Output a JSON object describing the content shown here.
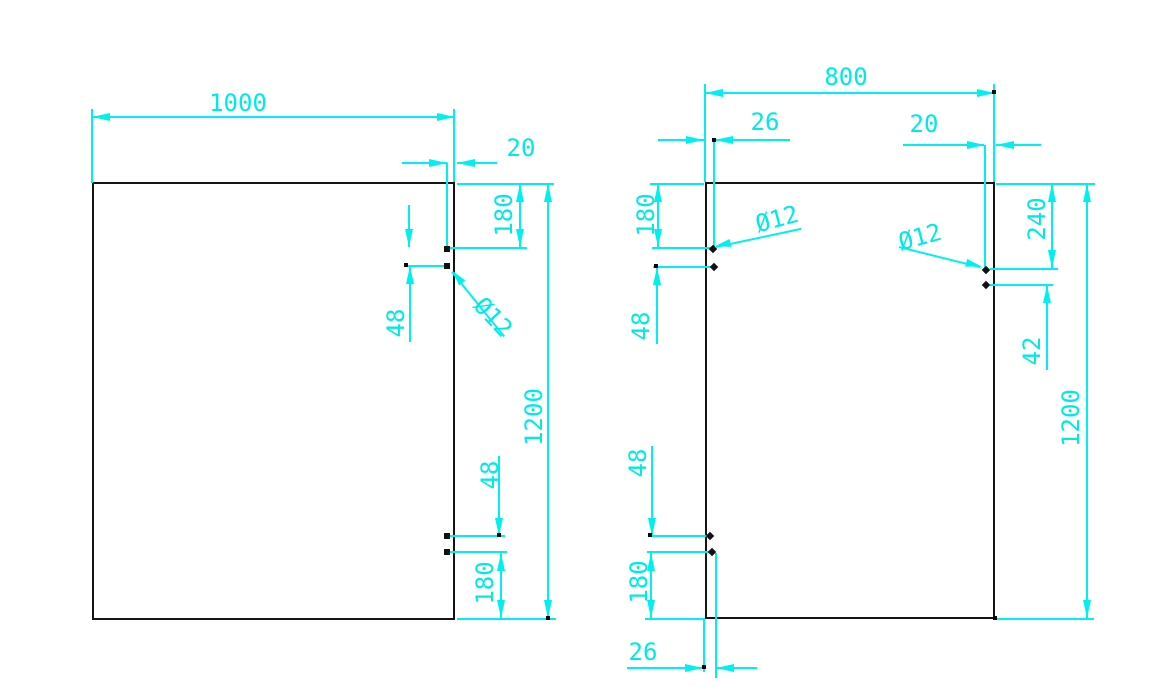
{
  "drawing_type": "CAD panel drilling drawing, two rectangular panels with cyan dimensions",
  "colors": {
    "dimension": "#00f0f0",
    "outline": "#141414",
    "background": "#ffffff"
  },
  "left_panel": {
    "width": "1000",
    "height": "1200",
    "hole_edge_offset": "20",
    "top_corner_offset": "180",
    "top_hole_spacing": "48",
    "hole_diameter": "Ø12",
    "bottom_hole_spacing": "48",
    "bottom_corner_offset": "180"
  },
  "right_panel": {
    "width": "800",
    "height": "1200",
    "left_hole_edge_offset": "26",
    "right_hole_edge_offset": "20",
    "left_top_corner_offset": "180",
    "left_hole_diameter": "Ø12",
    "right_hole_diameter": "Ø12",
    "right_top_corner_offset": "240",
    "left_top_hole_spacing": "48",
    "right_hole_spacing": "42",
    "left_bottom_hole_spacing": "48",
    "left_bottom_corner_offset": "180",
    "bottom_hole_edge_offset": "26"
  }
}
